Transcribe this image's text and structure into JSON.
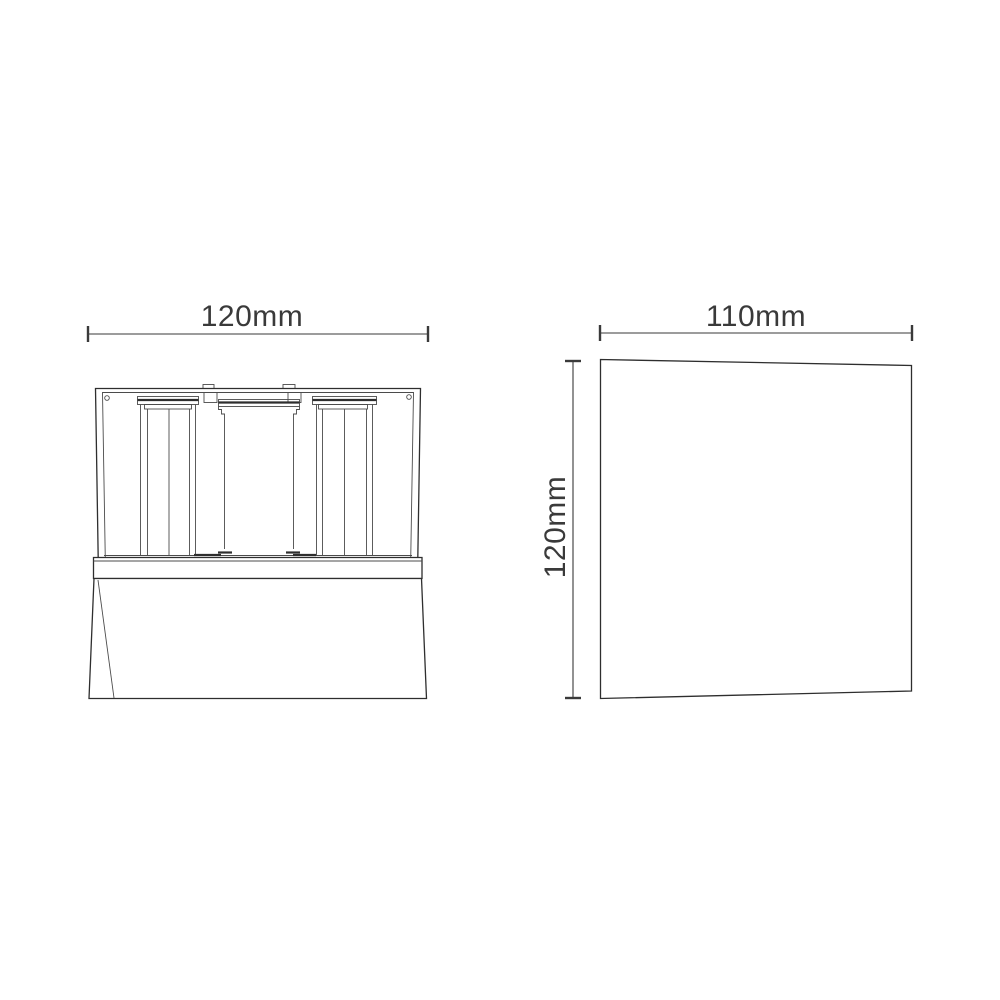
{
  "page": {
    "background_color": "#ffffff",
    "kind": "dimensioned technical line drawing, two orthographic views of a luminaire"
  },
  "drawing": {
    "colors": {
      "line": "#2e2e2e",
      "line_light": "#4b4b4b",
      "dimension": "#3a3a3a",
      "text": "#3a3a3a"
    },
    "views": {
      "front": {
        "name": "front view",
        "width_label": "120mm"
      },
      "side": {
        "name": "side view",
        "width_label": "110mm",
        "height_label": "120mm"
      }
    }
  }
}
